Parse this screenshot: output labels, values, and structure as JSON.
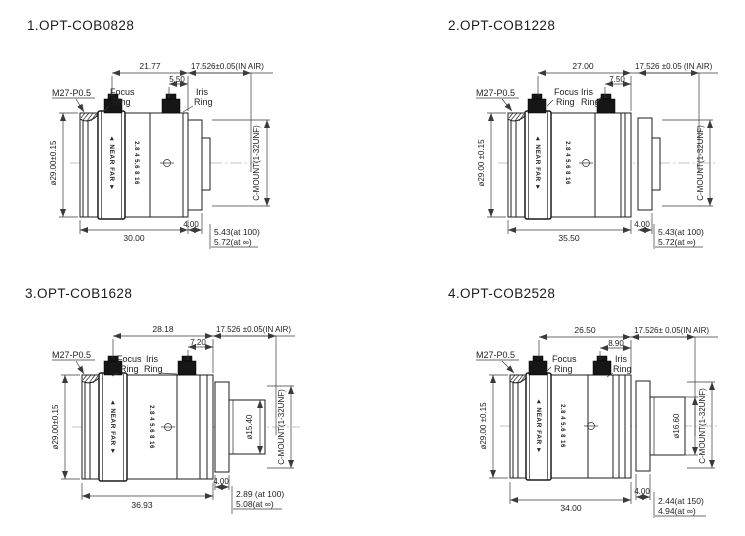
{
  "colors": {
    "ink": "#1c1c1c",
    "dimension_lines": "#3a3a3a",
    "background": "#ffffff"
  },
  "lenses": [
    {
      "title": "1.OPT-COB0828",
      "labels": {
        "thread": "M27-P0.5",
        "focus1": "Focus",
        "focus2": "Ring",
        "iris1": "Iris",
        "iris2": "Ring",
        "diameter": "ø29.00±0.15",
        "mount": "C-MOUNT(1-32UNF)",
        "near_far": "◄ NEAR  FAR ►",
        "aperture": "2.8 4 5.6 8 16"
      },
      "dims": {
        "focus_to_flange": "21.77",
        "iris_to_flange": "5.50",
        "flange_air": "17.526±0.05(IN AIR)",
        "length": "30.00",
        "step": "4.00",
        "bfl_near": "5.43(at 100)",
        "bfl_inf": "5.72(at ∞)"
      }
    },
    {
      "title": "2.OPT-COB1228",
      "labels": {
        "thread": "M27-P0.5",
        "focus1": "Focus",
        "focus2": "Ring",
        "iris1": "Iris",
        "iris2": "Ring",
        "diameter": "ø29.00 ±0.15",
        "mount": "C-MOUNT(1-32UNF)",
        "near_far": "◄ NEAR  FAR ►",
        "aperture": "2.8 4 5.6 8 16"
      },
      "dims": {
        "focus_to_flange": "27.00",
        "iris_to_flange": "7.50",
        "flange_air": "17.526 ±0.05 (IN AIR)",
        "length": "35.50",
        "step": "4.00",
        "bfl_near": "5.43(at 100)",
        "bfl_inf": "5.72(at ∞)"
      }
    },
    {
      "title": "3.OPT-COB1628",
      "labels": {
        "thread": "M27-P0.5",
        "focus1": "Focus",
        "focus2": "Ring",
        "iris1": "Iris",
        "iris2": "Ring",
        "diameter": "ø29.00±0.15",
        "mount": "C-MOUNT(1-32UNF)",
        "rear_diameter": "ø15.40",
        "near_far": "◄ NEAR  FAR ►",
        "aperture": "2.8 4 5.6 8 16"
      },
      "dims": {
        "focus_to_flange": "28.18",
        "iris_to_flange": "7.20",
        "flange_air": "17.526 ±0.05(IN AIR)",
        "length": "36.93",
        "step": "4.00",
        "bfl_near": "2.89 (at 100)",
        "bfl_inf": "5.08(at ∞)"
      }
    },
    {
      "title": "4.OPT-COB2528",
      "labels": {
        "thread": "M27-P0.5",
        "focus1": "Focus",
        "focus2": "Ring",
        "iris1": "Iris",
        "iris2": "Ring",
        "diameter": "ø29.00 ±0.15",
        "mount": "C-MOUNT(1-32UNF)",
        "rear_diameter": "ø16.60",
        "near_far": "◄ NEAR  FAR ►",
        "aperture": "2.8 4 5.6 8 16"
      },
      "dims": {
        "focus_to_flange": "26.50",
        "iris_to_flange": "8.90",
        "flange_air": "17.526± 0.05(IN AIR)",
        "length": "34.00",
        "step": "4.00",
        "bfl_near": "2.44(at 150)",
        "bfl_inf": "4.94(at ∞)"
      }
    }
  ]
}
